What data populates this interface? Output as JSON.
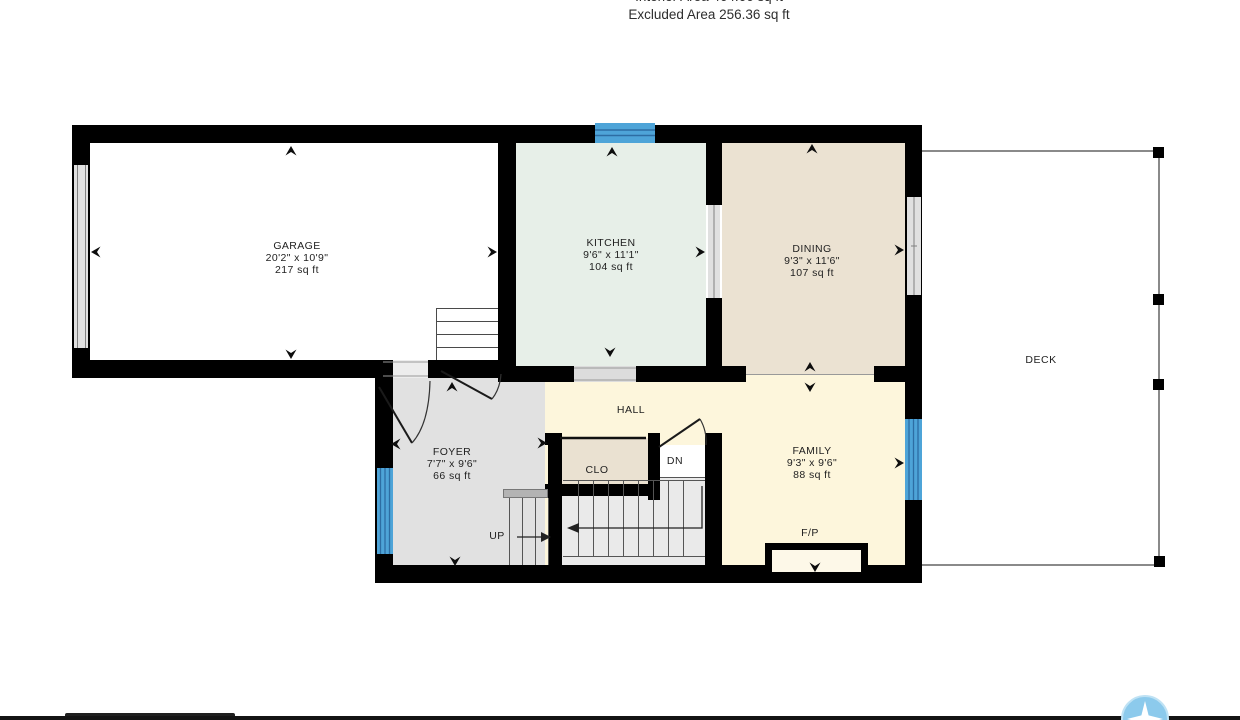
{
  "header": {
    "interior_area_line": "Interior Area 464.66 sq ft",
    "excluded_area_line": "Excluded Area 256.36 sq ft"
  },
  "rooms": {
    "garage": {
      "name": "GARAGE",
      "dims": "20'2\" x 10'9\"",
      "area": "217 sq ft"
    },
    "kitchen": {
      "name": "KITCHEN",
      "dims": "9'6\" x 11'1\"",
      "area": "104 sq ft"
    },
    "dining": {
      "name": "DINING",
      "dims": "9'3\" x 11'6\"",
      "area": "107 sq ft"
    },
    "foyer": {
      "name": "FOYER",
      "dims": "7'7\" x 9'6\"",
      "area": "66 sq ft"
    },
    "family": {
      "name": "FAMILY",
      "dims": "9'3\" x 9'6\"",
      "area": "88 sq ft"
    }
  },
  "labels": {
    "hall": "HALL",
    "closet": "CLO",
    "stairs_down": "DN",
    "stairs_up": "UP",
    "fireplace": "F/P",
    "deck": "DECK"
  },
  "colors": {
    "wall": "#000000",
    "window_blue": "#4ea4d8",
    "window_blue_line": "#2d6da3",
    "window_gray": "#e0e0e0",
    "floor_garage": "#ffffff",
    "floor_kitchen": "#e7efe8",
    "floor_dining": "#ebe2d2",
    "floor_family_hall": "#fdf6dc",
    "floor_foyer": "#e1e1e1",
    "floor_closet": "#eae1d1",
    "deck_line": "#8a8a8a",
    "logo_blue": "#8ccaec"
  }
}
